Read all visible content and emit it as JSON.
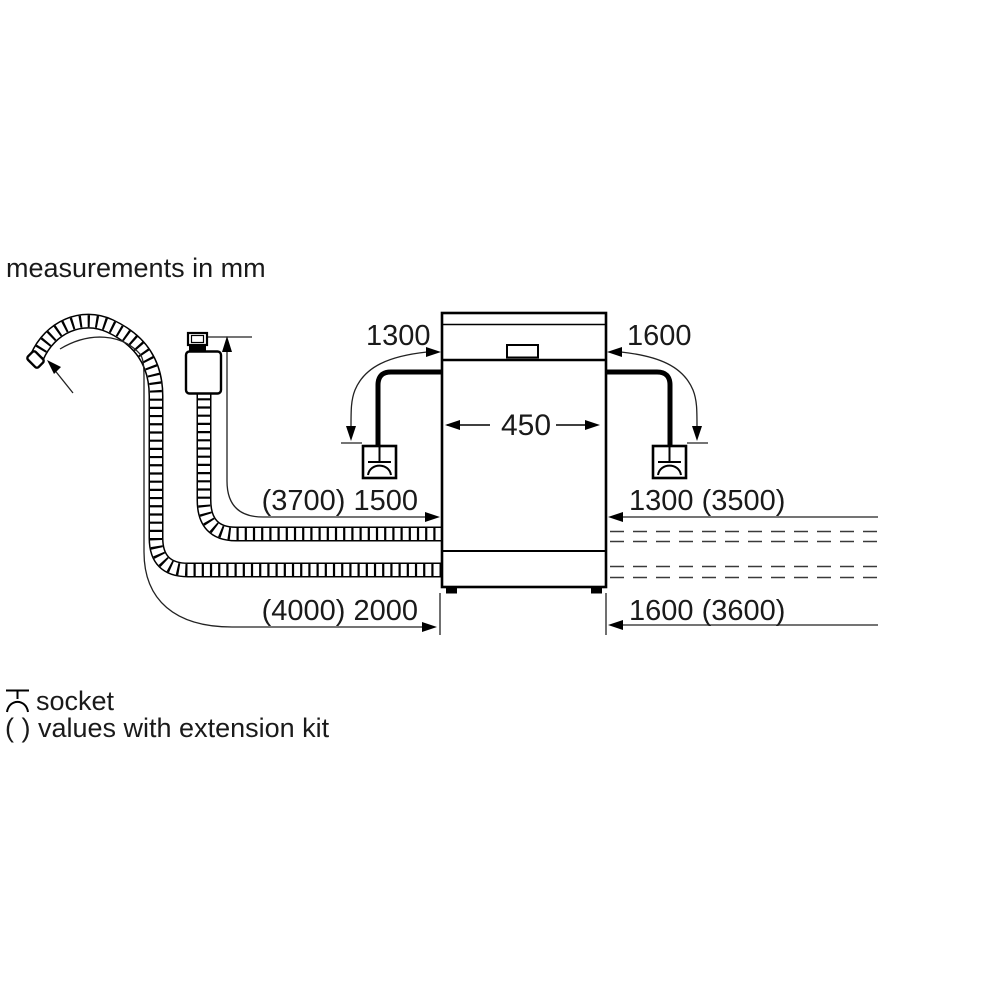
{
  "note": "measurements in mm",
  "dimensions": {
    "cable_left": "1300",
    "cable_right": "1600",
    "appliance_width": "450",
    "supply_hose_left": "(3700) 1500",
    "right_upper": "1300 (3500)",
    "drain_hose_left": "(4000) 2000",
    "right_lower": "1600 (3600)"
  },
  "legend": {
    "socket": "socket",
    "extension": "( ) values with extension kit"
  },
  "colors": {
    "line": "#000000",
    "background": "#ffffff",
    "text": "#1a1a1a"
  }
}
